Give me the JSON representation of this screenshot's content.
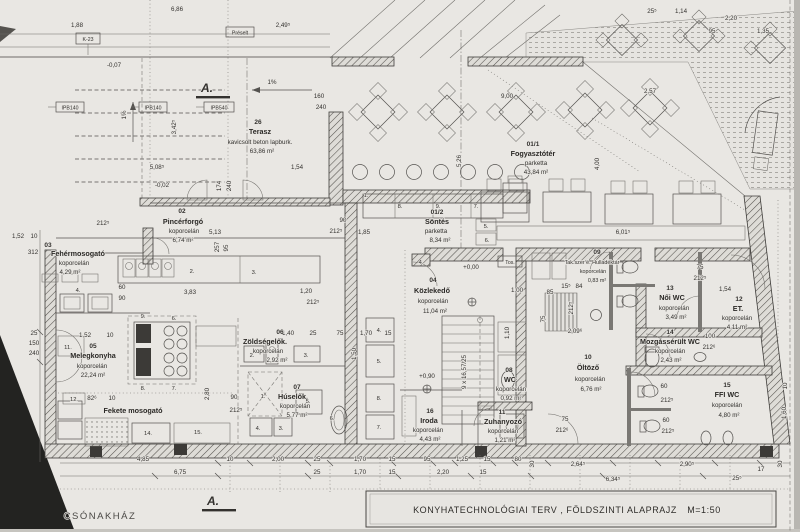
{
  "title_block": {
    "title": "KONYHATECHNOLÓGIAI TERV , FÖLDSZINTI ALAPRAJZ",
    "scale": "M=1:50"
  },
  "annotations": {
    "section_marker": "A.",
    "boathouse": "CSÓNAKHÁZ",
    "box_k23": "K-23",
    "box_ipb140": "IPB140",
    "box_ipb540": "IPB540",
    "box_preselt": "Préselt",
    "box_tos": "Tos."
  },
  "rooms": [
    {
      "num": "01/1",
      "name": "Fogyasztótér",
      "material": "parketta",
      "area": "43,84 m²"
    },
    {
      "num": "01/2",
      "name": "Söntés",
      "material": "parketta",
      "area": "8,34 m²"
    },
    {
      "num": "02",
      "name": "Pincérforgó",
      "material": "koporcelán",
      "area": "6,74 m²"
    },
    {
      "num": "03",
      "name": "Fehérmosogató",
      "material": "koporcelán",
      "area": "4,29 m²"
    },
    {
      "num": "04",
      "name": "Közlekedő",
      "material": "koporcelán",
      "area": "11,04 m²"
    },
    {
      "num": "05",
      "name": "Melegkonyha",
      "material": "koporcelán",
      "area": "22,24 m²"
    },
    {
      "num": "06",
      "name": "Zöldségelők.",
      "material": "koporcelán",
      "area": "2,92 m²"
    },
    {
      "num": "07",
      "name": "Húselők.",
      "material": "koporcelán",
      "area": "5,77 m²"
    },
    {
      "num": "08",
      "name": "WC",
      "material": "koporcelán",
      "area": "0,92 m²"
    },
    {
      "num": "09",
      "name": "Tak.szer é. Hulladéktár",
      "material": "koporcelán",
      "area": "0,83 m²"
    },
    {
      "num": "10",
      "name": "Öltöző",
      "material": "koporcelán",
      "area": "6,76 m²"
    },
    {
      "num": "11",
      "name": "Zuhanyozó",
      "material": "koporcelán",
      "area": "1,21 m²"
    },
    {
      "num": "12",
      "name": "ET.",
      "material": "koporcelán",
      "area": "4,11 m²"
    },
    {
      "num": "13",
      "name": "Női WC",
      "material": "koporcelán",
      "area": "3,49 m²"
    },
    {
      "num": "14",
      "name": "Mozgássérült WC",
      "material": "koporcelán",
      "area": "2,43 m²"
    },
    {
      "num": "15",
      "name": "FFI WC",
      "material": "koporcelán",
      "area": "4,80 m²"
    },
    {
      "num": "16",
      "name": "Iroda",
      "material": "koporcelán",
      "area": "4,43 m²"
    },
    {
      "num": "26",
      "name": "Terasz",
      "material": "kavicsolt beton lapburk.",
      "area": "63,86 m²"
    },
    {
      "num": "",
      "name": "Fekete mosogató",
      "material": "",
      "area": ""
    }
  ],
  "equip": [
    "1.",
    "8.",
    "9.",
    "7.",
    "5.",
    "6.",
    "2.",
    "3.",
    "4.",
    "9.",
    "6.",
    "8.",
    "7.",
    "11.",
    "12.",
    "14.",
    "15.",
    "2.",
    "3.",
    "1.",
    "5.",
    "4.",
    "3.",
    "6.",
    "4.",
    "5.",
    "8.",
    "7.",
    "4."
  ],
  "dims": [
    "1,88",
    "6,86",
    "2,49⁵",
    "-0,07",
    "25⁵",
    "1,14",
    "2,20",
    "95",
    "1,35",
    "160",
    "240",
    "1%",
    "1%",
    "3,42⁵",
    "5,08⁵",
    "-0,02",
    "1,54",
    "174",
    "240",
    "9,00",
    "2,57",
    "4,00",
    "6,01⁵",
    "5,13",
    "257",
    "95",
    "3,83",
    "1,20",
    "60",
    "90",
    "1,52",
    "10",
    "312",
    "25",
    "150",
    "240",
    "+0,00",
    "+0,90",
    "9 x 16,57/25",
    "1,00",
    "1,10",
    "75",
    "212⁵",
    "2,09⁶",
    "1,54",
    "100",
    "212⁶",
    "60",
    "212⁵",
    "60",
    "212⁵",
    "75",
    "212⁶",
    "4,85",
    "6,75",
    "10",
    "2,00",
    "25",
    "1,70",
    "15",
    "95",
    "1,25",
    "15",
    "25",
    "1,70",
    "15",
    "2,20",
    "15",
    "80",
    "30",
    "2,64⁵",
    "2,90⁵",
    "25⁵",
    "17",
    "30",
    "6,34⁵",
    "5,26",
    "212⁵",
    "212⁵",
    "1,40",
    "25",
    "75",
    "1,70",
    "15",
    "1,50",
    "90",
    "212⁵",
    "1,85",
    "82⁶",
    "10",
    "2,80",
    "90",
    "212⁵",
    "10",
    "1,60",
    "1,52",
    "10",
    "75",
    "212⁵",
    "85",
    "15⁵",
    "84"
  ],
  "colors": {
    "paper": "#e9e7e3",
    "ink": "#3a3a3a",
    "shadow": "#b8b6b1",
    "wedge": "#232321"
  }
}
